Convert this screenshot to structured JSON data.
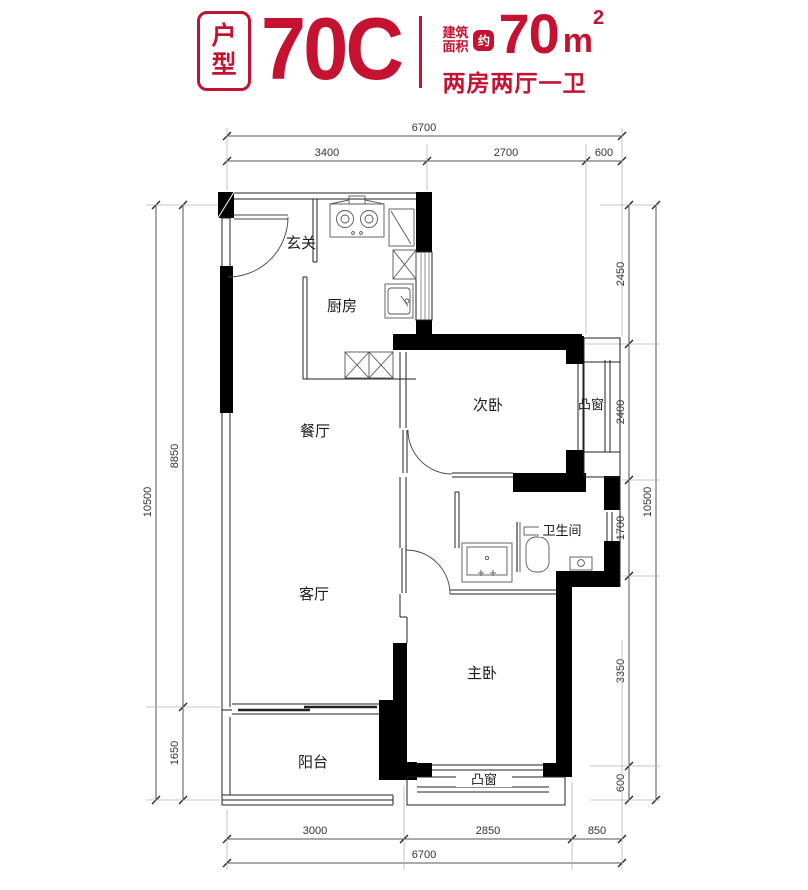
{
  "header": {
    "badge_line1": "户",
    "badge_line2": "型",
    "unit_code": "70C",
    "area_label_line1": "建筑",
    "area_label_line2": "面积",
    "approx": "约",
    "area_value": "70",
    "area_unit": "m",
    "area_superscript": "2",
    "layout_text": "两房两厅一卫",
    "accent_color": "#c51230"
  },
  "floorplan": {
    "wall_color": "#000000",
    "line_color": "#555555",
    "rooms": [
      {
        "id": "entry",
        "label": "玄关"
      },
      {
        "id": "kitchen",
        "label": "厨房"
      },
      {
        "id": "dining",
        "label": "餐厅"
      },
      {
        "id": "secondary-bedroom",
        "label": "次卧"
      },
      {
        "id": "bay-window-right",
        "label": "凸窗"
      },
      {
        "id": "bathroom",
        "label": "卫生间"
      },
      {
        "id": "living-room",
        "label": "客厅"
      },
      {
        "id": "master-bedroom",
        "label": "主卧"
      },
      {
        "id": "balcony",
        "label": "阳台"
      },
      {
        "id": "bay-window-bottom",
        "label": "凸窗"
      }
    ],
    "dimensions": {
      "top_total": "6700",
      "top": [
        "3400",
        "2700",
        "600"
      ],
      "left_total": "10500",
      "left": [
        "8850",
        "1650"
      ],
      "right_total": "10500",
      "right": [
        "2450",
        "2400",
        "1700",
        "3350",
        "600"
      ],
      "bottom": [
        "3000",
        "2850",
        "850"
      ],
      "bottom_total": "6700"
    }
  }
}
